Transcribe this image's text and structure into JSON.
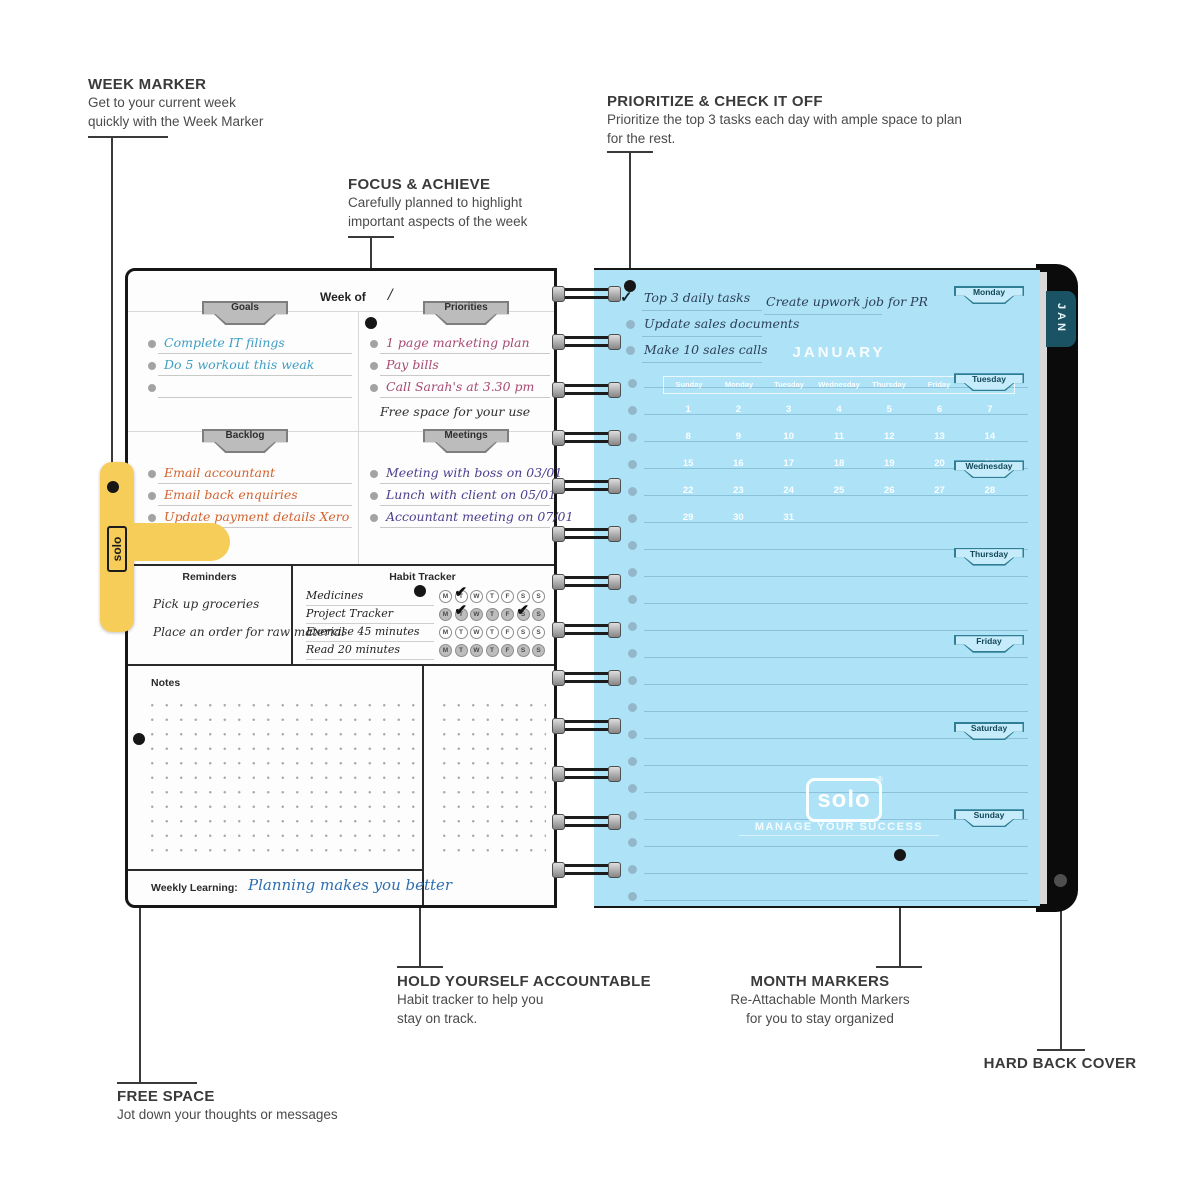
{
  "annotations": {
    "week_marker": {
      "title": "WEEK MARKER",
      "line1": "Get to your current week",
      "line2": "quickly with the Week Marker"
    },
    "focus": {
      "title": "FOCUS & ACHIEVE",
      "line1": "Carefully planned to highlight",
      "line2": "important aspects of the week"
    },
    "prioritize": {
      "title": "PRIORITIZE & CHECK IT OFF",
      "line1": "Prioritize the top 3 tasks each day with ample space to plan",
      "line2": "for the rest."
    },
    "accountable": {
      "title": "HOLD YOURSELF ACCOUNTABLE",
      "line1": "Habit tracker to help you",
      "line2": "stay on track."
    },
    "month_markers": {
      "title": "MONTH MARKERS",
      "line1": "Re-Attachable Month Markers",
      "line2": "for you to stay organized"
    },
    "hard_back": {
      "title": "HARD BACK COVER"
    },
    "free_space": {
      "title": "FREE SPACE",
      "line1": "Jot down your thoughts or messages"
    }
  },
  "left_page": {
    "week_of_label": "Week of",
    "week_of_value": "/",
    "goals": {
      "label": "Goals",
      "items": [
        "Complete IT filings",
        "Do 5 workout this weak",
        ""
      ]
    },
    "priorities": {
      "label": "Priorities",
      "items": [
        "1 page marketing plan",
        "Pay bills",
        "Call Sarah's at 3.30 pm"
      ],
      "free_note": "Free space for your use"
    },
    "backlog": {
      "label": "Backlog",
      "items": [
        "Email accountant",
        "Email back enquiries",
        "Update payment details Xero"
      ]
    },
    "meetings": {
      "label": "Meetings",
      "items": [
        "Meeting with boss on 03/01",
        "Lunch with client on 05/01",
        "Accountant meeting on 07/01"
      ]
    },
    "reminders": {
      "label": "Reminders",
      "items": [
        "Pick up groceries",
        "Place an order for raw material"
      ]
    },
    "habit_tracker": {
      "label": "Habit Tracker",
      "days": [
        "M",
        "T",
        "W",
        "T",
        "F",
        "S",
        "S"
      ],
      "rows": [
        {
          "name": "Medicines",
          "shade": "light",
          "checked": [
            1
          ]
        },
        {
          "name": "Project Tracker",
          "shade": "dark",
          "checked": [
            1,
            5
          ]
        },
        {
          "name": "Exercise 45 minutes",
          "shade": "light",
          "checked": []
        },
        {
          "name": "Read 20 minutes",
          "shade": "dark",
          "checked": []
        }
      ]
    },
    "notes_label": "Notes",
    "weekly_learning_label": "Weekly Learning:",
    "weekly_learning_value": "Planning makes you better"
  },
  "week_marker_tab": {
    "logo": "solo"
  },
  "right_page": {
    "tasks": [
      {
        "text": "Top 3 daily tasks",
        "checked": true
      },
      {
        "text": "Update sales documents",
        "checked": false
      },
      {
        "text": "Make 10 sales calls",
        "checked": false
      }
    ],
    "side_note": "Create upwork job for PR",
    "calendar": {
      "title": "JANUARY",
      "day_headers": [
        "Sunday",
        "Monday",
        "Tuesday",
        "Wednesday",
        "Thursday",
        "Friday",
        "Saturday"
      ],
      "weeks": [
        [
          "1",
          "2",
          "3",
          "4",
          "5",
          "6",
          "7"
        ],
        [
          "8",
          "9",
          "10",
          "11",
          "12",
          "13",
          "14"
        ],
        [
          "15",
          "16",
          "17",
          "18",
          "19",
          "20",
          "21"
        ],
        [
          "22",
          "23",
          "24",
          "25",
          "26",
          "27",
          "28"
        ],
        [
          "29",
          "30",
          "31",
          "",
          "",
          "",
          ""
        ]
      ]
    },
    "month_tabs": [
      "Monday",
      "Tuesday",
      "Wednesday",
      "Thursday",
      "Friday",
      "Saturday",
      "Sunday"
    ],
    "logo": "solo",
    "logo_reg": "®",
    "tagline": "MANAGE YOUR SUCCESS",
    "spine_tab": "JAN"
  },
  "colors": {
    "page_blue": "#aee3f7",
    "marker_yellow": "#f7cd5a",
    "goals_ink": "#3d9ec4",
    "priorities_ink": "#a84a72",
    "backlog_ink": "#d2622e",
    "meetings_ink": "#4a3f8f",
    "weekly_ink": "#2f6fb0",
    "cover_black": "#0b0b0b",
    "tab_teal": "#1a5364"
  }
}
